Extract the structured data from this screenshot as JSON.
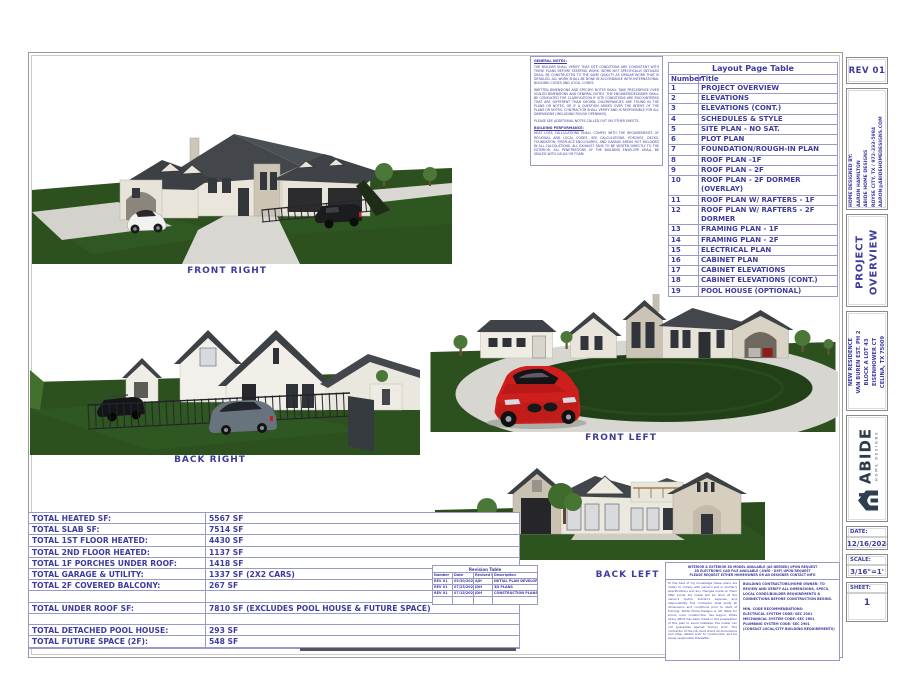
{
  "colors": {
    "ink": "#3c3c9e",
    "table_border": "#9a9ac8",
    "lawn": "#2c501e",
    "roof": "#43474b",
    "wall": "#eae6db",
    "stone": "#cbc4b4",
    "accent_red": "#cf1f1d"
  },
  "general_notes": {
    "heading": "GENERAL NOTES:",
    "paragraphs": [
      "THE BUILDER SHALL VERIFY THAT SITE CONDITIONS ARE CONSISTENT WITH THESE PLANS BEFORE STARTING WORK. WORK NOT SPECIFICALLY DETAILED SHALL BE CONSTRUCTED TO THE SAME QUALITY AS SIMILAR WORK THAT IS DETAILED. ALL WORK SHALL BE DONE IN ACCORDANCE WITH INTERNATIONAL BUILDING CODES AND LOCAL CODES.",
      "WRITTEN DIMENSIONS AND SPECIFIC NOTES SHALL TAKE PRECEDENCE OVER SCALED DIMENSIONS AND GENERAL NOTES. THE ENGINEER/DESIGNER SHALL BE CONSULTED FOR CLARIFICATION IF SITE CONDITIONS ARE ENCOUNTERED THAT ARE DIFFERENT THAN SHOWN, DISCREPANCIES ARE FOUND IN THE PLANS OR NOTES, OR IF A QUESTION ARISES OVER THE INTENT OF THE PLANS OR NOTES. CONTRACTOR SHALL VERIFY AND IS RESPONSIBLE FOR ALL DIMENSIONS (INCLUDING ROUGH OPENINGS).",
      "PLEASE SEE ADDITIONAL NOTES CALLED OUT ON OTHER SHEETS."
    ],
    "heading2": "BUILDING PERFORMANCE:",
    "paragraphs2": [
      "HEAT LOSS CALCULATIONS SHALL COMPLY WITH THE REQUIREMENTS OF REGIONAL AND LOCAL CODES. SEE CALCULATIONS. PORCHES, DECKS, FOUNDATION, FIREPLACE ENCLOSURES, AND GARAGE AREAS NOT INCLUDED IN ALL CALCULATIONS. ALL EXHAUST FANS TO BE VENTED DIRECTLY TO THE EXTERIOR. ALL PENETRATIONS OF THE BUILDING ENVELOPE SHALL BE SEALED WITH CAULK OR FOAM."
    ]
  },
  "layout_page_table": {
    "title": "Layout Page Table",
    "headers": [
      "Number",
      "Title"
    ],
    "rows": [
      [
        "1",
        "PROJECT OVERVIEW"
      ],
      [
        "2",
        "ELEVATIONS"
      ],
      [
        "3",
        "ELEVATIONS (CONT.)"
      ],
      [
        "4",
        "SCHEDULES & STYLE"
      ],
      [
        "5",
        "SITE PLAN - NO SAT."
      ],
      [
        "6",
        "PLOT PLAN"
      ],
      [
        "7",
        "FOUNDATION/ROUGH-IN PLAN"
      ],
      [
        "8",
        "ROOF PLAN -1F"
      ],
      [
        "9",
        "ROOF PLAN - 2F"
      ],
      [
        "10",
        "ROOF PLAN - 2F DORMER (OVERLAY)"
      ],
      [
        "11",
        "ROOF PLAN W/ RAFTERS - 1F"
      ],
      [
        "12",
        "ROOF PLAN W/ RAFTERS - 2F DORMER"
      ],
      [
        "13",
        "FRAMING PLAN - 1F"
      ],
      [
        "14",
        "FRAMING PLAN - 2F"
      ],
      [
        "15",
        "ELECTRICAL PLAN"
      ],
      [
        "16",
        "CABINET PLAN"
      ],
      [
        "17",
        "CABINET ELEVATIONS"
      ],
      [
        "18",
        "CABINET ELEVATIONS (CONT.)"
      ],
      [
        "19",
        "POOL HOUSE (OPTIONAL)"
      ]
    ]
  },
  "views": [
    {
      "label": "FRONT RIGHT"
    },
    {
      "label": "BACK RIGHT"
    },
    {
      "label": "FRONT LEFT"
    },
    {
      "label": "BACK LEFT"
    }
  ],
  "sf_table": {
    "rows": [
      {
        "label": "TOTAL HEATED SF:",
        "value": "5567 SF"
      },
      {
        "label": "TOTAL SLAB SF:",
        "value": "7514 SF"
      },
      {
        "label": "TOTAL 1ST FLOOR HEATED:",
        "value": "4430 SF"
      },
      {
        "label": "TOTAL 2ND FLOOR HEATED:",
        "value": "1137 SF"
      },
      {
        "label": "TOTAL 1F PORCHES UNDER ROOF:",
        "value": "1418 SF"
      },
      {
        "label": "TOTAL GARAGE & UTILITY:",
        "value": "1337 SF (2X2 CARS)"
      },
      {
        "label": "TOTAL 2F COVERED BALCONY:",
        "value": "267 SF"
      },
      {
        "label": "",
        "value": ""
      },
      {
        "label": "TOTAL UNDER ROOF SF:",
        "value": "7810 SF (EXCLUDES POOL HOUSE & FUTURE SPACE)"
      },
      {
        "label": "",
        "value": ""
      },
      {
        "label": "TOTAL DETACHED POOL HOUSE:",
        "value": "293 SF"
      },
      {
        "label": "TOTAL FUTURE SPACE (2F):",
        "value": "548 SF"
      }
    ]
  },
  "revision_table": {
    "title": "Revision Table",
    "headers": [
      "Number",
      "Date",
      "Revised By",
      "Description"
    ],
    "rows": [
      [
        "REV 01",
        "05/30/2024",
        "AJH",
        "INITIAL PLAN DEVELOPMENT"
      ],
      [
        "REV 01",
        "07/23/2024",
        "JDH",
        "3D PLANS"
      ],
      [
        "REV 01",
        "07/15/2024",
        "JDH",
        "CONSTRUCTION PLANS"
      ],
      [
        "",
        "",
        "",
        ""
      ]
    ]
  },
  "bottom_notes": {
    "header_lines": [
      "INTERIOR & EXTERIOR 3D MODEL AVAILABLE (AS NEEDED) UPON REQUEST",
      "2D ELECTRONIC CAD FILE AVAILABLE (.DWG - DXF) UPON REQUEST",
      "PLEASE REQUEST EITHER HOMEOWNER OR AN DESIGNER CONTACT INFO"
    ],
    "disclaimer": "To the best of my knowledge these plans are drawn to comply with owner's and or builder's specifications and any changes made on them after prints are made will be done at the owner's and/or builder's expense and responsibility. The contractor shall verify all dimensions and conditions prior to start of framing. Abide Home Designs is not liable for errors once construction has begun. While every effort has been made in the preparation of this plan to avoid mistakes, the maker can not guarantee against human error. The contractor of the job must check all dimensions and other details prior to construction and be solely responsible thereafter.",
    "contractor_note": "BUILDING CONTRACTORS/HOME OWNER: TO REVIEW AND VERIFY ALL DIMENSIONS, SPECS, LOCAL CODES/BUILDER REQUIREMENTS & CONNECTIONS BEFORE CONSTRUCTION BEGINS.",
    "code_heading": "MIN. CODE RECOMMENDATIONS:",
    "code_lines": [
      "ELECTRICAL SYSTEM CODE:  SEC 2301",
      "MECHANICAL SYSTEM CODE:  SEC 2601",
      "PLUMBING SYSTEM CODE:  SEC 2901",
      "(CONSULT LOCAL/CITY BUILDING REQUIREMENTS)"
    ]
  },
  "title_block": {
    "rev": "REV 01",
    "designer_lines": [
      "HOME DESIGNED BY:",
      "AARON HAMILTON",
      "ABIDE HOME DESIGNS",
      "ROYSE CITY, TX / 972-333-5984",
      "AARON@ABIDEHOMEDESIGNS.COM"
    ],
    "sheet_title_lines": [
      "PROJECT",
      "OVERVIEW"
    ],
    "project_lines": [
      "NEW RESIDENCE",
      "VAN BUREN EST. PH 2",
      "BLOCK A LOT 43",
      "EISENHOWER CT",
      "CELINA, TX 75009"
    ],
    "logo_brand": "ABIDE",
    "logo_sub": "HOME DESIGNS",
    "date_label": "DATE:",
    "date_value": "12/16/2024",
    "scale_label": "SCALE:",
    "scale_value": "3/16\"=1'",
    "sheet_label": "SHEET:",
    "sheet_value": "1"
  }
}
